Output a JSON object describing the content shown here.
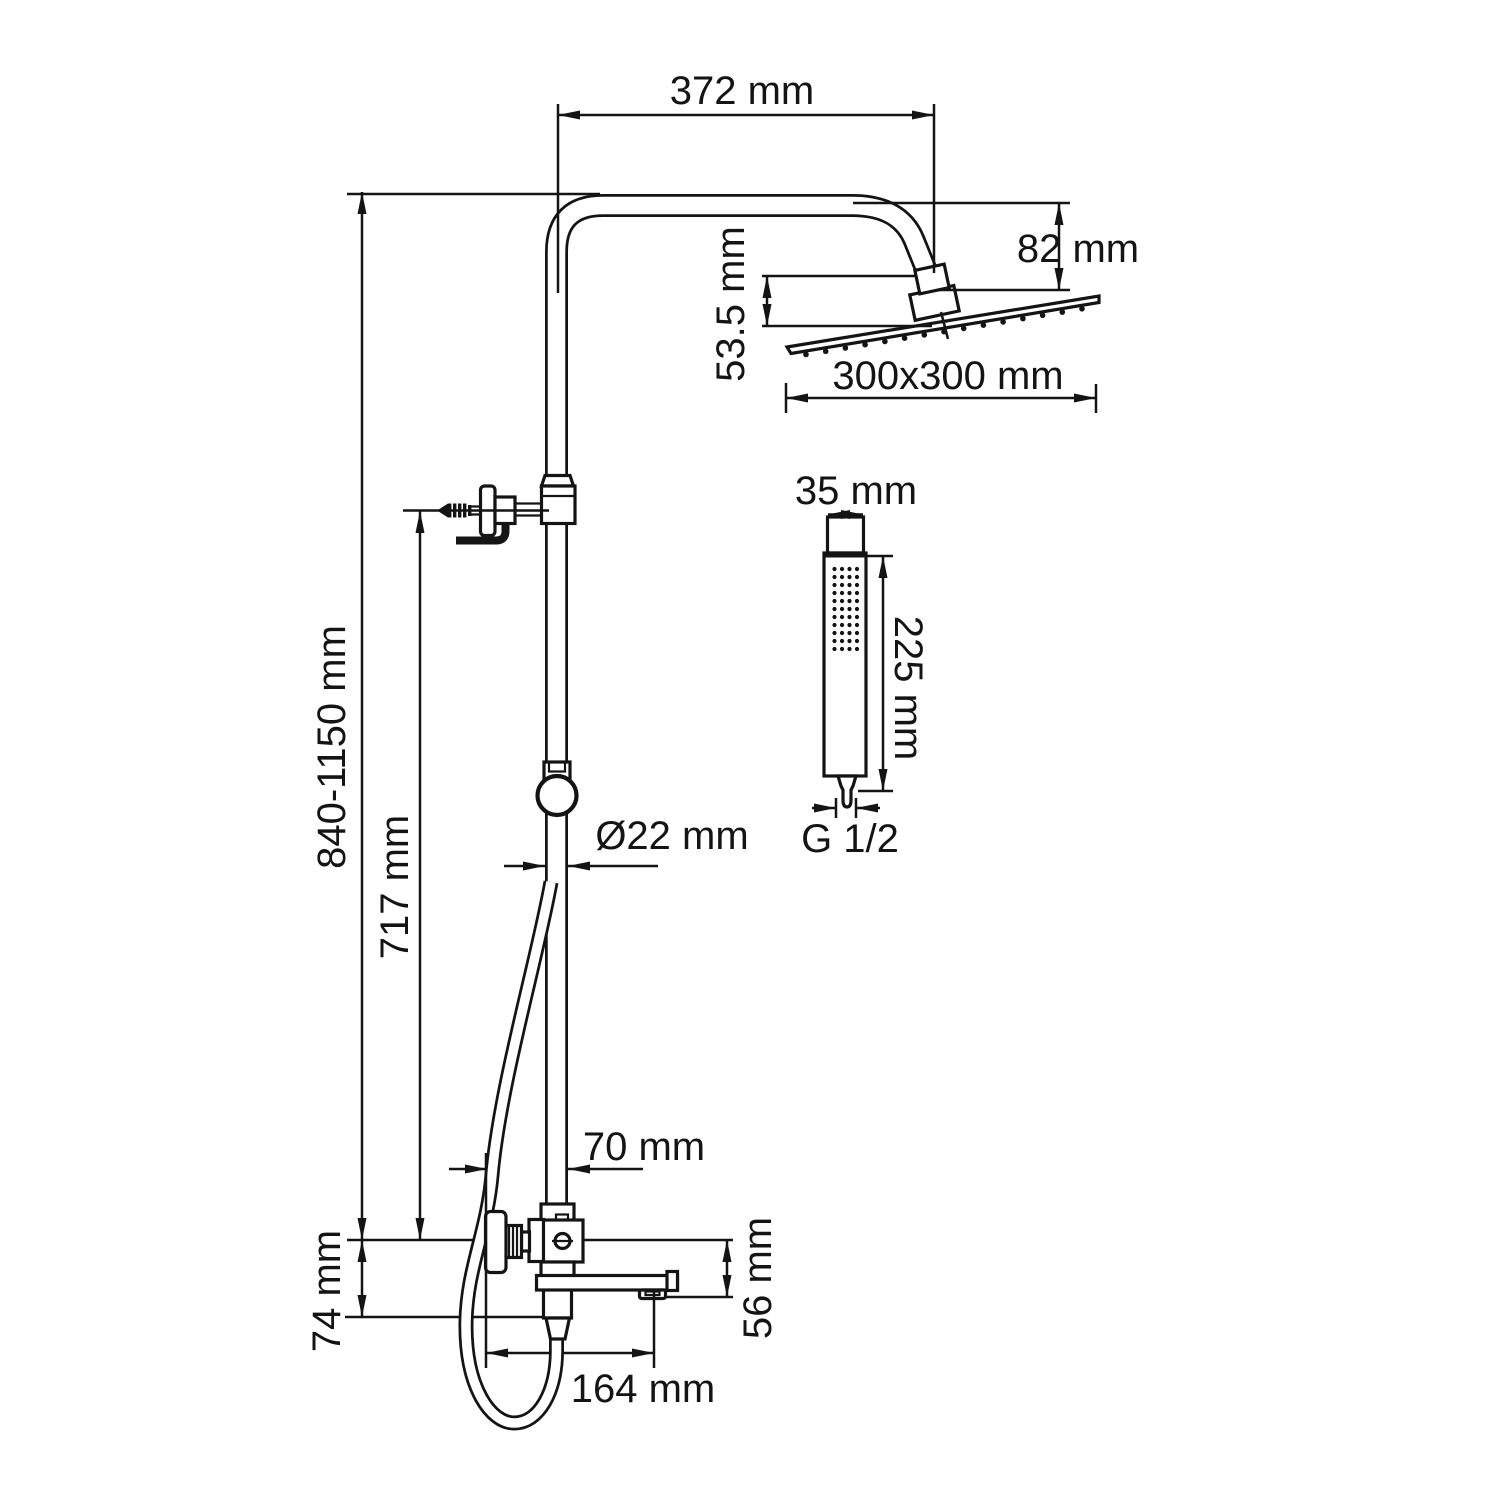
{
  "diagram": {
    "kind": "shower-column-technical-drawing",
    "dims": {
      "width372": "372 mm",
      "drop82": "82 mm",
      "offset535": "53.5 mm",
      "head300": "300x300 mm",
      "hand35": "35 mm",
      "hand225": "225 mm",
      "thread": "G 1/2",
      "dia22": "Ø22 mm",
      "range840": "840-1150 mm",
      "height717": "717 mm",
      "offset70": "70 mm",
      "drop56": "56 mm",
      "reach164": "164 mm",
      "drop74": "74 mm"
    },
    "line_color": "#141414",
    "background": "#ffffff"
  }
}
